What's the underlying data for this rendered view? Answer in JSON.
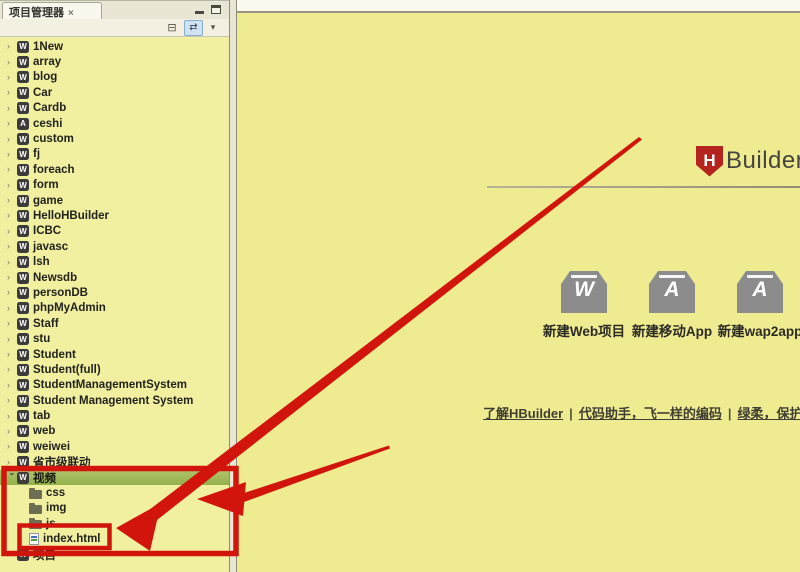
{
  "panel": {
    "tab_title": "项目管理器",
    "toolbar": {
      "collapse_all_icon": "collapse-all",
      "link_with_editor_icon": "link-with-editor",
      "view_menu_icon": "view-menu"
    }
  },
  "tree": {
    "items": [
      {
        "label": "1New",
        "icon": "web-project",
        "level": 0,
        "state": "collapsed"
      },
      {
        "label": "array",
        "icon": "web-project",
        "level": 0,
        "state": "collapsed"
      },
      {
        "label": "blog",
        "icon": "web-project",
        "level": 0,
        "state": "collapsed"
      },
      {
        "label": "Car",
        "icon": "web-project",
        "level": 0,
        "state": "collapsed"
      },
      {
        "label": "Cardb",
        "icon": "web-project",
        "level": 0,
        "state": "collapsed"
      },
      {
        "label": "ceshi",
        "icon": "app-project",
        "level": 0,
        "state": "collapsed"
      },
      {
        "label": "custom",
        "icon": "web-project",
        "level": 0,
        "state": "collapsed"
      },
      {
        "label": "fj",
        "icon": "web-project",
        "level": 0,
        "state": "collapsed"
      },
      {
        "label": "foreach",
        "icon": "web-project",
        "level": 0,
        "state": "collapsed"
      },
      {
        "label": "form",
        "icon": "web-project",
        "level": 0,
        "state": "collapsed"
      },
      {
        "label": "game",
        "icon": "web-project",
        "level": 0,
        "state": "collapsed"
      },
      {
        "label": "HelloHBuilder",
        "icon": "web-project",
        "level": 0,
        "state": "collapsed"
      },
      {
        "label": "ICBC",
        "icon": "web-project",
        "level": 0,
        "state": "collapsed"
      },
      {
        "label": "javasc",
        "icon": "web-project",
        "level": 0,
        "state": "collapsed"
      },
      {
        "label": "lsh",
        "icon": "web-project",
        "level": 0,
        "state": "collapsed"
      },
      {
        "label": "Newsdb",
        "icon": "web-project",
        "level": 0,
        "state": "collapsed"
      },
      {
        "label": "personDB",
        "icon": "web-project",
        "level": 0,
        "state": "collapsed"
      },
      {
        "label": "phpMyAdmin",
        "icon": "web-project",
        "level": 0,
        "state": "collapsed"
      },
      {
        "label": "Staff",
        "icon": "web-project",
        "level": 0,
        "state": "collapsed"
      },
      {
        "label": "stu",
        "icon": "web-project",
        "level": 0,
        "state": "collapsed"
      },
      {
        "label": "Student",
        "icon": "web-project",
        "level": 0,
        "state": "collapsed"
      },
      {
        "label": "Student(full)",
        "icon": "web-project",
        "level": 0,
        "state": "collapsed"
      },
      {
        "label": "StudentManagementSystem",
        "icon": "web-project",
        "level": 0,
        "state": "collapsed"
      },
      {
        "label": "Student Management System",
        "icon": "web-project",
        "level": 0,
        "state": "collapsed"
      },
      {
        "label": "tab",
        "icon": "web-project",
        "level": 0,
        "state": "collapsed"
      },
      {
        "label": "web",
        "icon": "web-project",
        "level": 0,
        "state": "collapsed"
      },
      {
        "label": "weiwei",
        "icon": "web-project",
        "level": 0,
        "state": "collapsed"
      },
      {
        "label": "省市级联动",
        "icon": "web-project",
        "level": 0,
        "state": "collapsed"
      },
      {
        "label": "视频",
        "icon": "web-project",
        "level": 0,
        "state": "expanded",
        "selected": true
      },
      {
        "label": "css",
        "icon": "folder",
        "level": 1
      },
      {
        "label": "img",
        "icon": "folder",
        "level": 1
      },
      {
        "label": "js",
        "icon": "folder",
        "level": 1
      },
      {
        "label": "index.html",
        "icon": "html-file",
        "level": 1
      },
      {
        "label": "项目",
        "icon": "web-project",
        "level": 0,
        "state": "collapsed"
      }
    ]
  },
  "main": {
    "logo": {
      "letter": "H",
      "text": "Builder"
    },
    "actions": [
      {
        "letter": "W",
        "label": "新建Web项目"
      },
      {
        "letter": "A",
        "label": "新建移动App"
      },
      {
        "letter": "A",
        "label": "新建wap2app"
      }
    ],
    "links": [
      "了解HBuilder",
      "代码助手，飞一样的编码",
      "绿柔，保护你的眼睛"
    ],
    "separator": "|"
  },
  "colors": {
    "annotation_red": "#d2150c",
    "selection_green": "#9cb456",
    "logo_red": "#b5231f",
    "panel_bg": "#f1f0a0",
    "main_bg": "#efeb90"
  }
}
